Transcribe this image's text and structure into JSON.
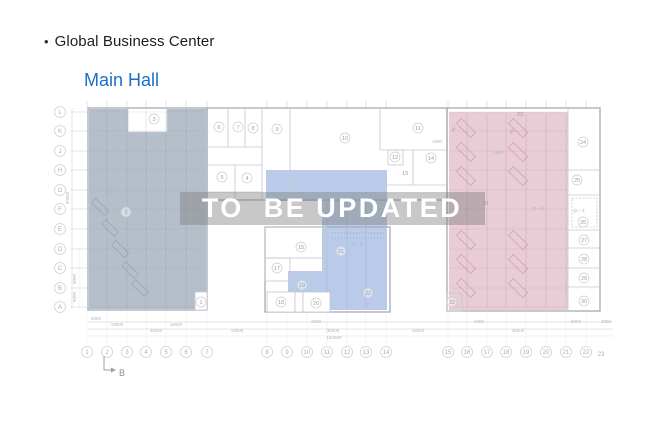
{
  "header": {
    "bullet": "•",
    "title": "Global Business Center",
    "subtitle": "Main Hall"
  },
  "watermark": {
    "text": "TO  BE UPDATED"
  },
  "colors": {
    "subtitle_link": "#1b6fc8",
    "region_left": "#b5bfc9",
    "region_middle": "#b9cbe9",
    "region_right": "#e9cdd6",
    "watermark_bg": "#7d7d7d",
    "watermark_text": "#ffffff"
  },
  "plan": {
    "axis_columns": [
      {
        "label": "1",
        "x": 87
      },
      {
        "label": "2",
        "x": 107
      },
      {
        "label": "3",
        "x": 127
      },
      {
        "label": "4",
        "x": 146
      },
      {
        "label": "5",
        "x": 166
      },
      {
        "label": "6",
        "x": 186
      },
      {
        "label": "7",
        "x": 207
      },
      {
        "label": "8",
        "x": 267
      },
      {
        "label": "9",
        "x": 287
      },
      {
        "label": "10",
        "x": 307
      },
      {
        "label": "11",
        "x": 327
      },
      {
        "label": "12",
        "x": 347
      },
      {
        "label": "13",
        "x": 366
      },
      {
        "label": "14",
        "x": 386
      },
      {
        "label": "15",
        "x": 448
      },
      {
        "label": "16",
        "x": 467
      },
      {
        "label": "17",
        "x": 487
      },
      {
        "label": "18",
        "x": 506
      },
      {
        "label": "19",
        "x": 526
      },
      {
        "label": "20",
        "x": 546
      },
      {
        "label": "21",
        "x": 566
      },
      {
        "label": "22",
        "x": 586
      },
      {
        "label": "23",
        "x": 601,
        "plain": true
      }
    ],
    "axis_rows": [
      {
        "label": "L",
        "y": 112
      },
      {
        "label": "K",
        "y": 131
      },
      {
        "label": "J",
        "y": 151
      },
      {
        "label": "H",
        "y": 170
      },
      {
        "label": "G",
        "y": 190
      },
      {
        "label": "F",
        "y": 209
      },
      {
        "label": "E",
        "y": 229
      },
      {
        "label": "D",
        "y": 249
      },
      {
        "label": "C",
        "y": 268
      },
      {
        "label": "B",
        "y": 288
      },
      {
        "label": "A",
        "y": 307
      }
    ],
    "rooms": [
      {
        "label": "1",
        "x": 201,
        "y": 302
      },
      {
        "label": "2",
        "x": 126,
        "y": 212
      },
      {
        "label": "3",
        "x": 154,
        "y": 119
      },
      {
        "label": "4",
        "x": 247,
        "y": 178
      },
      {
        "label": "5",
        "x": 222,
        "y": 177
      },
      {
        "label": "6",
        "x": 219,
        "y": 127
      },
      {
        "label": "7",
        "x": 238,
        "y": 127
      },
      {
        "label": "8",
        "x": 253,
        "y": 128
      },
      {
        "label": "9",
        "x": 277,
        "y": 129
      },
      {
        "label": "10",
        "x": 345,
        "y": 138
      },
      {
        "label": "11",
        "x": 418,
        "y": 128
      },
      {
        "label": "12",
        "x": 395,
        "y": 157
      },
      {
        "label": "13",
        "x": 405,
        "y": 173,
        "plain": true
      },
      {
        "label": "14",
        "x": 431,
        "y": 158
      },
      {
        "label": "15",
        "x": 301,
        "y": 247
      },
      {
        "label": "17",
        "x": 277,
        "y": 268
      },
      {
        "label": "18",
        "x": 281,
        "y": 302
      },
      {
        "label": "19",
        "x": 302,
        "y": 285
      },
      {
        "label": "20",
        "x": 316,
        "y": 303
      },
      {
        "label": "21",
        "x": 341,
        "y": 251
      },
      {
        "label": "22",
        "x": 368,
        "y": 293
      },
      {
        "label": "23",
        "x": 520,
        "y": 114,
        "plain": true
      },
      {
        "label": "24",
        "x": 583,
        "y": 142
      },
      {
        "label": "25",
        "x": 577,
        "y": 180
      },
      {
        "label": "26",
        "x": 583,
        "y": 222
      },
      {
        "label": "27",
        "x": 584,
        "y": 240
      },
      {
        "label": "28",
        "x": 584,
        "y": 259
      },
      {
        "label": "29",
        "x": 584,
        "y": 278
      },
      {
        "label": "30",
        "x": 584,
        "y": 301
      },
      {
        "label": "31",
        "x": 486,
        "y": 203,
        "plain": true
      },
      {
        "label": "32",
        "x": 452,
        "y": 302
      }
    ],
    "zone_labels": [
      {
        "text": "Q = 3",
        "x": 113,
        "y": 193
      },
      {
        "text": "Q = 3",
        "x": 357,
        "y": 245
      },
      {
        "text": "Q = 3",
        "x": 538,
        "y": 210
      },
      {
        "text": "Q = 3",
        "x": 579,
        "y": 212
      }
    ],
    "angle_labels": [
      {
        "text": "45°",
        "x": 455,
        "y": 130
      },
      {
        "text": "45°",
        "x": 513,
        "y": 132
      }
    ],
    "dim_labels": [
      {
        "v": "1900",
        "x": 437,
        "y": 143
      },
      {
        "v": "1900",
        "x": 498,
        "y": 154
      },
      {
        "v": "2000",
        "x": 100,
        "y": 217
      },
      {
        "v": "6000",
        "x": 96,
        "y": 320
      },
      {
        "v": "18000",
        "x": 117,
        "y": 326
      },
      {
        "v": "18000",
        "x": 176,
        "y": 326
      },
      {
        "v": "36000",
        "x": 156,
        "y": 332
      },
      {
        "v": "18000",
        "x": 237,
        "y": 332
      },
      {
        "v": "2000",
        "x": 316,
        "y": 323
      },
      {
        "v": "36000",
        "x": 333,
        "y": 332
      },
      {
        "v": "152869",
        "x": 334,
        "y": 339
      },
      {
        "v": "18400",
        "x": 418,
        "y": 332
      },
      {
        "v": "1000",
        "x": 479,
        "y": 323
      },
      {
        "v": "45000",
        "x": 518,
        "y": 332
      },
      {
        "v": "6000",
        "x": 576,
        "y": 323
      },
      {
        "v": "3000",
        "x": 606,
        "y": 323
      }
    ],
    "dim_labels_vertical": [
      {
        "v": "60000",
        "x": 69,
        "y": 198
      },
      {
        "v": "6000",
        "x": 76,
        "y": 279
      },
      {
        "v": "6000",
        "x": 76,
        "y": 297
      }
    ],
    "section_marker": "B"
  }
}
